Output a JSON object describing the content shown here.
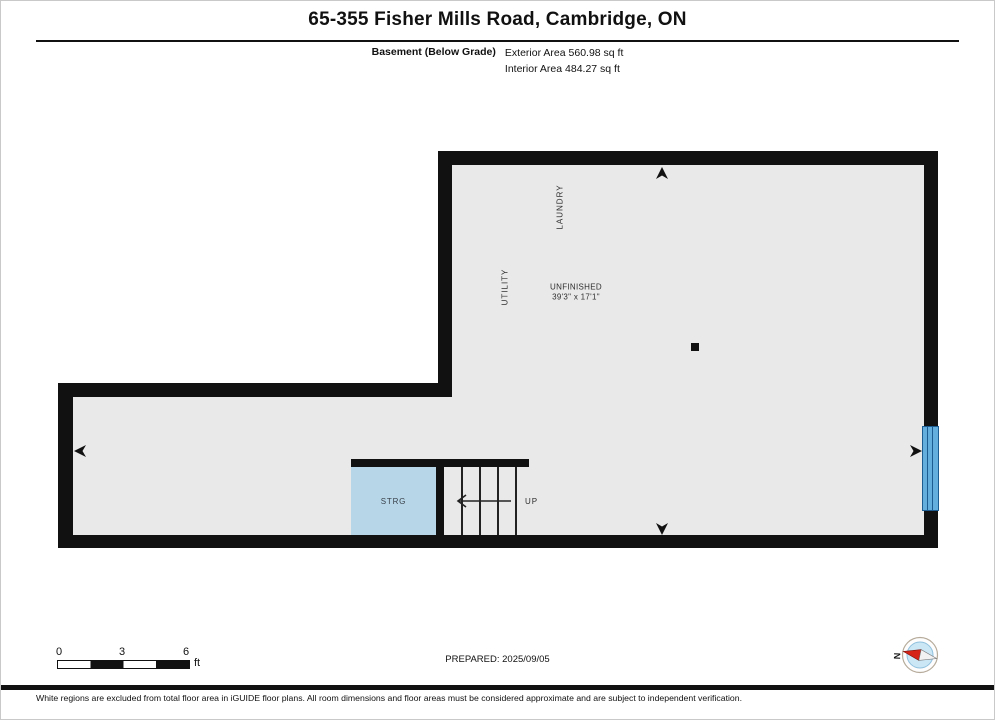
{
  "header": {
    "title": "65-355 Fisher Mills Road, Cambridge, ON",
    "floor_label": "Basement (Below Grade)",
    "exterior_area": "Exterior Area 560.98 sq ft",
    "interior_area": "Interior Area 484.27 sq ft"
  },
  "plan": {
    "rooms": {
      "laundry": "LAUNDRY",
      "utility": "UTILITY",
      "unfinished": "UNFINISHED",
      "unfinished_dims": "39'3\" x 17'1\"",
      "storage": "STRG",
      "stairs_direction": "UP"
    },
    "icons": {
      "direction_markers": [
        "arrow-up-icon",
        "arrow-down-icon",
        "arrow-left-icon",
        "arrow-right-icon"
      ],
      "window": "window-icon",
      "stairs_arrow": "stairs-up-arrow-icon",
      "compass": "compass-icon"
    },
    "colors": {
      "wall": "#111111",
      "floor": "#e9e9e9",
      "storage_fill": "#b7d7e8",
      "window_fill": "#64aedd",
      "window_line": "#1c5c90",
      "compass_needle": "#d62418",
      "compass_face": "#cbe7f5"
    }
  },
  "scale_bar": {
    "ticks": [
      "0",
      "3",
      "6"
    ],
    "unit": "ft"
  },
  "footer": {
    "prepared": "PREPARED: 2025/09/05",
    "compass_north": "N",
    "disclaimer": "White regions are excluded from total floor area in iGUIDE floor plans. All room dimensions and floor areas must be considered approximate and are subject to independent verification."
  }
}
